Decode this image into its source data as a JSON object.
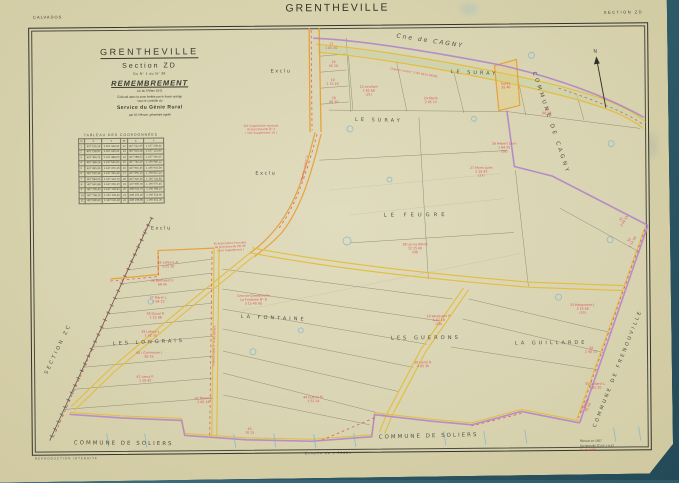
{
  "page": {
    "department": "CALVADOS",
    "title": "GRENTHEVILLE",
    "section_label": "SECTION  ZD"
  },
  "title_block": {
    "commune": "GRENTHEVILLE",
    "section": "Section  ZD",
    "range": "Du N° 1 au N° 38",
    "operation": "REMEMBREMENT",
    "law": "Loi  du  9  Mars  1941",
    "note1": "Exécuté dans la zone limitée par le liseré orange",
    "note2": "sous le contrôle du",
    "service": "Service du Génie Rural",
    "surveyor": "par M. Hémon, géomètre agréé"
  },
  "coord_table": {
    "title": "TABLEAU  DES  COORDONNÉES",
    "headers": [
      "Pt",
      "X",
      "Y",
      "Pt",
      "X",
      "Y"
    ],
    "rows": [
      [
        "1",
        "407 125,14",
        "1 167 342,60",
        "12",
        "407 512,35",
        "1 167 208,44"
      ],
      [
        "2",
        "407 218,50",
        "1 167 415,22",
        "13",
        "407 604,18",
        "1 167 131,90"
      ],
      [
        "3",
        "407 304,72",
        "1 167 488,05",
        "14",
        "407 688,52",
        "1 167 060,35"
      ],
      [
        "4",
        "407 398,16",
        "1 167 540,80",
        "15",
        "407 742,20",
        "1 166 985,12"
      ],
      [
        "5",
        "407 455,90",
        "1 167 470,15",
        "16",
        "407 810,45",
        "1 166 902,58"
      ],
      [
        "6",
        "407 520,34",
        "1 167 395,48",
        "17",
        "407 865,10",
        "1 166 815,24"
      ],
      [
        "7",
        "407 584,05",
        "1 167 322,70",
        "18",
        "407 920,65",
        "1 166 742,80"
      ],
      [
        "8",
        "407 640,88",
        "1 167 250,35",
        "19",
        "407 985,30",
        "1 166 670,45"
      ],
      [
        "9",
        "407 705,42",
        "1 167 178,90",
        "20",
        "408 042,75",
        "1 166 598,10"
      ],
      [
        "10",
        "407 768,15",
        "1 167 105,52",
        "21",
        "408 105,20",
        "1 166 524,66"
      ],
      [
        "11",
        "407 830,60",
        "1 167 032,18",
        "22",
        "408 168,85",
        "1 166 452,30"
      ]
    ]
  },
  "footer": {
    "left": "REPRODUCTION  INTERDITE",
    "scale": "Échelle  de  1:2000e",
    "right_line1": "Rénové en 1957",
    "right_line2": "Grentheville  ZD  N° 1 à 47",
    "right_line3": "Vu et vérifié"
  },
  "map": {
    "colors": {
      "boundary_purple": "#b285c9",
      "road_yellow": "#e3bd3f",
      "road_orange": "#e8a23c",
      "annotation_red": "#d84a5c",
      "survey_blue": "#7ab4d4",
      "paper": "#d9d4b2"
    },
    "labels": [
      {
        "text": "Cne de CAGNY",
        "x": 398,
        "y": 38,
        "rot": 9,
        "size": 6,
        "ls": 2,
        "italic": true
      },
      {
        "text": "LE  SURAY",
        "x": 452,
        "y": 74,
        "rot": 3,
        "size": 5,
        "ls": 3
      },
      {
        "text": "LE  SURAY",
        "x": 356,
        "y": 121,
        "rot": 2,
        "size": 5,
        "ls": 3
      },
      {
        "text": "LE    FEUGRE",
        "x": 384,
        "y": 217,
        "rot": 0,
        "size": 5.2,
        "ls": 4
      },
      {
        "text": "LA    FONTAINE",
        "x": 240,
        "y": 317,
        "rot": 3,
        "size": 5,
        "ls": 3
      },
      {
        "text": "LES  LONGRAIS",
        "x": 112,
        "y": 343,
        "rot": -2,
        "size": 5,
        "ls": 3
      },
      {
        "text": "LES    GUERONS",
        "x": 390,
        "y": 340,
        "rot": 0,
        "size": 5.2,
        "ls": 3
      },
      {
        "text": "LA    GUILLARDE",
        "x": 514,
        "y": 346,
        "rot": 0,
        "size": 5,
        "ls": 3
      },
      {
        "text": "COMMUNE   DE   CAGNY",
        "x": 534,
        "y": 74,
        "rot": 72,
        "size": 5.5,
        "ls": 3
      },
      {
        "text": "COMMUNE  DE  FRENOUVILLE",
        "x": 594,
        "y": 430,
        "rot": -68,
        "size": 5,
        "ls": 2.5
      },
      {
        "text": "SECTION  ZC",
        "x": 46,
        "y": 372,
        "rot": -64,
        "size": 5,
        "ls": 2.5
      },
      {
        "text": "COMMUNE        DE        SOLIERS",
        "x": 72,
        "y": 442,
        "rot": 1,
        "size": 5.5,
        "ls": 2
      },
      {
        "text": "COMMUNE     DE     SOLIERS",
        "x": 377,
        "y": 439,
        "rot": -1,
        "size": 5.5,
        "ls": 2
      },
      {
        "text": "Exclu",
        "x": 272,
        "y": 72,
        "rot": 0,
        "size": 5,
        "ls": 1.5
      },
      {
        "text": "Exclu",
        "x": 256,
        "y": 174,
        "rot": 0,
        "size": 5,
        "ls": 1.5
      },
      {
        "text": "Exclu",
        "x": 151,
        "y": 228,
        "rot": 0,
        "size": 5,
        "ls": 1.5
      },
      {
        "text": "N",
        "x": 595,
        "y": 55,
        "rot": 0,
        "size": 5,
        "ls": 0
      }
    ],
    "red_notes": [
      {
        "x": 333,
        "y": 45,
        "lines": [
          "17",
          "1 05 20"
        ]
      },
      {
        "x": 335,
        "y": 63,
        "lines": [
          "18",
          "95 10"
        ]
      },
      {
        "x": 334,
        "y": 81,
        "lines": [
          "19",
          "1 12 45"
        ]
      },
      {
        "x": 335,
        "y": 99,
        "lines": [
          "20",
          "88 30"
        ]
      },
      {
        "x": 370,
        "y": 88,
        "lines": [
          "23  Levillain",
          "1 45 60",
          "(21)"
        ]
      },
      {
        "x": 432,
        "y": 100,
        "lines": [
          "24  Marie",
          "2 05 15"
        ]
      },
      {
        "x": 507,
        "y": 86,
        "rot": -4,
        "lines": [
          "Suray",
          "35 40"
        ]
      },
      {
        "x": 505,
        "y": 146,
        "lines": [
          "26  Hébert Léon",
          "1 84 25",
          "(26)"
        ]
      },
      {
        "x": 548,
        "y": 112,
        "lines": [
          "25",
          "60 18"
        ]
      },
      {
        "x": 415,
        "y": 246,
        "lines": [
          "28  Lecoq Albert",
          "12 35 60",
          "(28)"
        ]
      },
      {
        "x": 482,
        "y": 170,
        "lines": [
          "27  Morin Jules",
          "5 18 42",
          "(27)"
        ]
      },
      {
        "x": 622,
        "y": 222,
        "rot": -58,
        "lines": [
          "31",
          "2 04 55"
        ]
      },
      {
        "x": 630,
        "y": 243,
        "rot": -58,
        "lines": [
          "32",
          "1 12 30"
        ]
      },
      {
        "x": 262,
        "y": 126,
        "size": 2.8,
        "lines": [
          "Sté Coopérative Agricole",
          "de Grentheville  N° 2",
          "( voir Supplément 19 )"
        ]
      },
      {
        "x": 230,
        "y": 243,
        "size": 2.8,
        "rot": -2,
        "lines": [
          "Et Association Foncière",
          "de Grentheville ZD 39",
          "( voir Supplément )"
        ]
      },
      {
        "x": 168,
        "y": 262,
        "lines": [
          "35  Lefèvre A.",
          "1 25 10"
        ]
      },
      {
        "x": 162,
        "y": 280,
        "lines": [
          "36  Berthelot P.",
          "98 45"
        ]
      },
      {
        "x": 158,
        "y": 297,
        "lines": [
          "37  Marie L.",
          "1 04 22"
        ]
      },
      {
        "x": 155,
        "y": 313,
        "lines": [
          "38  Duval R.",
          "1 15 08"
        ]
      },
      {
        "x": 150,
        "y": 331,
        "lines": [
          "39  Lebrun J.",
          "1 42 35"
        ]
      },
      {
        "x": 148,
        "y": 352,
        "lines": [
          "40  ( Commune )",
          "85 16"
        ]
      },
      {
        "x": 144,
        "y": 376,
        "lines": [
          "41  Leroy P.",
          "1 10 42"
        ]
      },
      {
        "x": 202,
        "y": 398,
        "lines": [
          "42  Morel Y.",
          "2 05 18"
        ]
      },
      {
        "x": 253,
        "y": 296,
        "lines": [
          "Cme de Grentheville",
          "La Fontaine  N° 8",
          "3 15 40   (8)"
        ]
      },
      {
        "x": 312,
        "y": 398,
        "lines": [
          "44  Guérin M.",
          "1 52 24"
        ]
      },
      {
        "x": 248,
        "y": 429,
        "lines": [
          "45",
          "70 15"
        ]
      },
      {
        "x": 438,
        "y": 318,
        "lines": [
          "29  Vauquelin P.",
          "6 42 18",
          "(29)"
        ]
      },
      {
        "x": 422,
        "y": 364,
        "lines": [
          "30  Lainé R.",
          "4 05 36"
        ]
      },
      {
        "x": 582,
        "y": 308,
        "lines": [
          "33  Marguerite J.",
          "3 15 48",
          "(33)"
        ]
      },
      {
        "x": 590,
        "y": 351,
        "lines": [
          "34",
          "2 40 12"
        ]
      },
      {
        "x": 594,
        "y": 387,
        "lines": [
          "35  Godard L.",
          "1 85 20"
        ]
      },
      {
        "x": 584,
        "y": 408,
        "rot": -62,
        "lines": [
          "47  Bisson",
          "95 40"
        ]
      },
      {
        "x": 415,
        "y": 74,
        "rot": 10,
        "size": 2.9,
        "lines": [
          "Chemin  rural  n° 3   dit   de  la  Vallée"
        ]
      },
      {
        "x": 306,
        "y": 168,
        "rot": -77,
        "size": 2.9,
        "lines": [
          "Chemin  rural  n° 2"
        ]
      },
      {
        "x": 214,
        "y": 345,
        "rot": -88,
        "size": 2.9,
        "lines": [
          "Chemin  rural  n° 4   de  Soliers"
        ]
      }
    ]
  }
}
